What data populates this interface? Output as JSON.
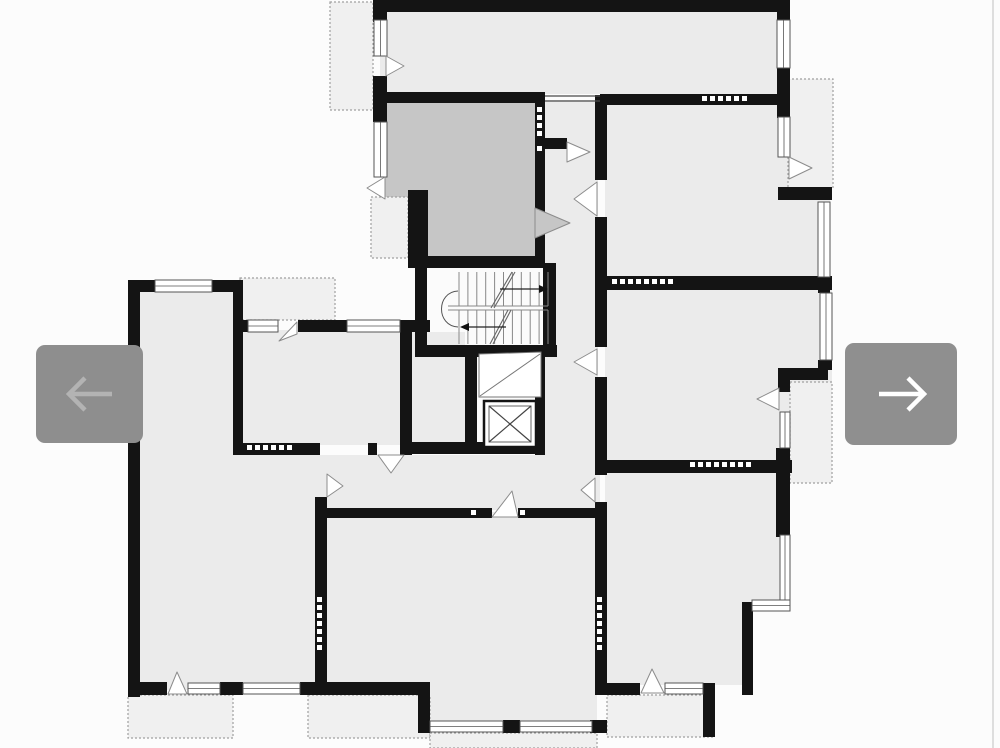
{
  "viewer": {
    "prev_button": {
      "icon": "arrow-left-icon",
      "background": "#8e8e8e",
      "arrow_color": "#b3b3b3"
    },
    "next_button": {
      "icon": "arrow-right-icon",
      "background": "#8f8f8f",
      "arrow_color": "#ffffff"
    },
    "edge_divider_color": "#dedede",
    "canvas_color": "#fcfcfc"
  },
  "floorplan": {
    "colors": {
      "wall": "#141414",
      "room": "#ebebeb",
      "vestibule": "#c6c6c6",
      "white": "#fbfbfb",
      "balcony": "#f0f0f0",
      "balcony_border": "#a0a0a0",
      "window_frame": "#555555",
      "door_line": "#8c8c8c",
      "stair_line": "#888888",
      "canvas": "#fcfcfc"
    },
    "rooms": [
      [
        380,
        8,
        398,
        86,
        "room"
      ],
      [
        605,
        103,
        225,
        175,
        "room"
      ],
      [
        605,
        288,
        227,
        174,
        "room"
      ],
      [
        605,
        471,
        183,
        131,
        "room"
      ],
      [
        605,
        602,
        139,
        83,
        "room"
      ],
      [
        543,
        100,
        55,
        410,
        "room"
      ],
      [
        385,
        100,
        150,
        158,
        "vestibule"
      ],
      [
        430,
        268,
        113,
        79,
        "white"
      ],
      [
        407,
        332,
        58,
        110,
        "room"
      ],
      [
        477,
        352,
        60,
        100,
        "white"
      ],
      [
        138,
        290,
        100,
        400,
        "room"
      ],
      [
        138,
        455,
        180,
        230,
        "room"
      ],
      [
        243,
        330,
        157,
        115,
        "room"
      ],
      [
        235,
        455,
        365,
        55,
        "room"
      ],
      [
        325,
        512,
        272,
        210,
        "room"
      ]
    ],
    "balconies": [
      [
        330,
        2,
        43,
        108
      ],
      [
        788,
        79,
        45,
        109
      ],
      [
        240,
        278,
        95,
        42
      ],
      [
        371,
        197,
        37,
        61
      ],
      [
        790,
        382,
        42,
        101
      ],
      [
        128,
        695,
        105,
        43
      ],
      [
        308,
        695,
        122,
        43
      ],
      [
        430,
        733,
        167,
        15
      ],
      [
        607,
        695,
        106,
        42
      ]
    ],
    "walls": [
      [
        373,
        0,
        407,
        12
      ],
      [
        373,
        12,
        14,
        10
      ],
      [
        373,
        76,
        14,
        46
      ],
      [
        383,
        92,
        162,
        11
      ],
      [
        600,
        94,
        190,
        11
      ],
      [
        777,
        0,
        13,
        20
      ],
      [
        777,
        68,
        13,
        50
      ],
      [
        778,
        187,
        54,
        13
      ],
      [
        595,
        95,
        12,
        85
      ],
      [
        595,
        217,
        12,
        130
      ],
      [
        595,
        377,
        12,
        98
      ],
      [
        595,
        502,
        12,
        193
      ],
      [
        535,
        97,
        10,
        171
      ],
      [
        545,
        138,
        22,
        11
      ],
      [
        408,
        190,
        20,
        77
      ],
      [
        408,
        256,
        137,
        12
      ],
      [
        415,
        256,
        12,
        101
      ],
      [
        543,
        263,
        13,
        87
      ],
      [
        418,
        345,
        139,
        12
      ],
      [
        465,
        352,
        12,
        100
      ],
      [
        535,
        350,
        10,
        105
      ],
      [
        407,
        442,
        138,
        12
      ],
      [
        597,
        276,
        235,
        14
      ],
      [
        818,
        277,
        12,
        16
      ],
      [
        818,
        360,
        14,
        10
      ],
      [
        778,
        368,
        50,
        12
      ],
      [
        778,
        378,
        12,
        14
      ],
      [
        776,
        448,
        14,
        89
      ],
      [
        600,
        460,
        192,
        13
      ],
      [
        128,
        280,
        12,
        417
      ],
      [
        128,
        280,
        27,
        12
      ],
      [
        212,
        280,
        28,
        12
      ],
      [
        233,
        280,
        10,
        175
      ],
      [
        233,
        320,
        15,
        12
      ],
      [
        298,
        320,
        49,
        12
      ],
      [
        400,
        320,
        30,
        12
      ],
      [
        400,
        332,
        12,
        123
      ],
      [
        233,
        443,
        87,
        12
      ],
      [
        368,
        443,
        9,
        12
      ],
      [
        315,
        497,
        12,
        188
      ],
      [
        323,
        508,
        169,
        10
      ],
      [
        518,
        508,
        77,
        10
      ],
      [
        128,
        682,
        39,
        13
      ],
      [
        220,
        682,
        23,
        13
      ],
      [
        300,
        682,
        130,
        13
      ],
      [
        418,
        683,
        12,
        50
      ],
      [
        503,
        720,
        17,
        13
      ],
      [
        590,
        720,
        17,
        13
      ],
      [
        600,
        683,
        40,
        12
      ],
      [
        703,
        683,
        12,
        54
      ],
      [
        742,
        602,
        11,
        93
      ]
    ],
    "windows": [
      [
        155,
        280,
        57,
        12
      ],
      [
        374,
        20,
        13,
        36
      ],
      [
        374,
        122,
        13,
        55
      ],
      [
        248,
        320,
        30,
        12
      ],
      [
        347,
        320,
        53,
        12
      ],
      [
        777,
        20,
        13,
        48
      ],
      [
        778,
        117,
        12,
        40
      ],
      [
        818,
        202,
        12,
        75
      ],
      [
        820,
        293,
        12,
        67
      ],
      [
        780,
        412,
        10,
        36
      ],
      [
        780,
        535,
        10,
        66
      ],
      [
        752,
        600,
        38,
        11
      ],
      [
        188,
        683,
        32,
        11
      ],
      [
        243,
        683,
        57,
        11
      ],
      [
        430,
        721,
        73,
        11
      ],
      [
        520,
        721,
        72,
        11
      ],
      [
        665,
        683,
        38,
        11
      ]
    ],
    "vents": [
      [
        702,
        96,
        "h",
        6
      ],
      [
        612,
        279,
        "h",
        8
      ],
      [
        690,
        462,
        "h",
        8
      ],
      [
        247,
        445,
        "h",
        6
      ],
      [
        537,
        107,
        "v",
        4
      ],
      [
        537,
        146,
        "v",
        1
      ],
      [
        317,
        597,
        "v",
        7
      ],
      [
        597,
        597,
        "v",
        7
      ],
      [
        471,
        510,
        "h",
        1
      ],
      [
        520,
        510,
        "h",
        1
      ]
    ],
    "threshold_lines": [
      [
        545,
        96,
        600,
        96
      ],
      [
        545,
        101,
        600,
        101
      ]
    ],
    "doors": [
      {
        "points": "386,56 404,66 386,76",
        "fill": "#ffffff"
      },
      {
        "points": "385,177 367,188 385,199",
        "fill": "#ffffff"
      },
      {
        "points": "535,208 570,223 535,238",
        "fill": "#c6c6c6"
      },
      {
        "points": "567,142 590,152 567,162",
        "fill": "#ffffff"
      },
      {
        "points": "597,182 574,199 597,216",
        "fill": "#ffffff"
      },
      {
        "points": "597,349 574,362 597,375",
        "fill": "#ffffff"
      },
      {
        "points": "779,388 757,399 779,410",
        "fill": "#ffffff"
      },
      {
        "points": "789,157 812,168 789,179",
        "fill": "#ffffff"
      },
      {
        "points": "297,322 279,341 297,334",
        "fill": "#ffffff"
      },
      {
        "points": "378,455 391,473 404,455",
        "fill": "#ffffff"
      },
      {
        "points": "327,474 343,486 327,497",
        "fill": "#ffffff"
      },
      {
        "points": "595,478 581,490 595,502",
        "fill": "#ffffff"
      },
      {
        "points": "492,517 512,491 518,517",
        "fill": "#ffffff"
      },
      {
        "points": "168,694 177,672 187,694",
        "fill": "#ffffff"
      },
      {
        "points": "641,693 652,669 664,693",
        "fill": "#ffffff"
      }
    ],
    "stairs": {
      "x0": 459,
      "x1": 548,
      "treads": 11,
      "y_top": 272,
      "y_mid1": 306,
      "y_mid2": 310,
      "y_bot": 344,
      "mid_x0": 448,
      "arc": "M 458 291 C 436 292 436 326 458 327",
      "arrows": [
        {
          "line": [
            500,
            289,
            539,
            289
          ],
          "head": "539,285 548,289 539,293"
        },
        {
          "line": [
            506,
            327,
            469,
            327
          ],
          "head": "469,323 460,327 469,331"
        }
      ],
      "breaks": [
        "M 491 308 L 512 272",
        "M 494 308 L 515 272",
        "M 490 344 L 508 310",
        "M 493 344 L 511 310"
      ]
    },
    "elevator": {
      "outer": [
        484,
        401,
        52,
        46
      ],
      "inner": [
        489,
        406,
        42,
        36
      ]
    },
    "shaft": {
      "poly": "479,354 541,352 541,397 479,397",
      "diag": [
        480,
        396,
        540,
        354
      ]
    }
  }
}
